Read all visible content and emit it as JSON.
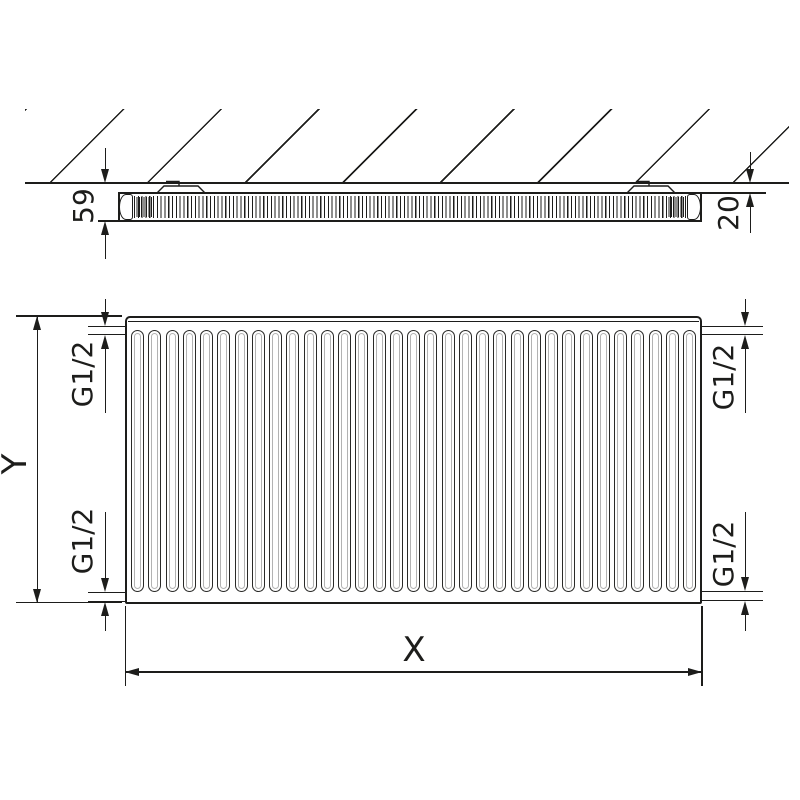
{
  "drawing": {
    "colors": {
      "line": "#1d1d1b"
    },
    "side_view": {
      "depth": "59",
      "wall_gap": "20"
    },
    "front_view": {
      "width": "X",
      "height": "Y",
      "conn_top_left": "G1/2",
      "conn_bottom_left": "G1/2",
      "conn_top_right": "G1/2",
      "conn_bottom_right": "G1/2",
      "fin_count": 33
    }
  }
}
